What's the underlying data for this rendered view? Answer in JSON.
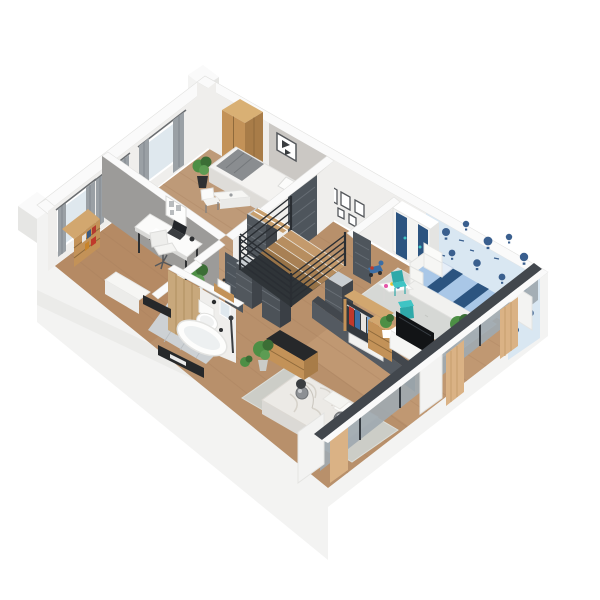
{
  "scene": {
    "type": "3d-floor-plan-cutaway-render",
    "view": "isometric-from-south-west",
    "background": "#ffffff"
  },
  "palette": {
    "background": "#ffffff",
    "exterior_wall": "#f3f3f2",
    "exterior_wall_shade": "#e6e6e4",
    "wall_top": "#fafafa",
    "wall_white": "#efeeec",
    "wall_gray": "#9c9b99",
    "wall_accent": "#cbc8c4",
    "dark_wall": "#42474d",
    "dark_door": "#4e555c",
    "chest_front": "#51575d",
    "chest_side": "#3f444a",
    "chest_top": "#c9ced2",
    "wood_floor": "#b8906b",
    "floor_bedroom": "#c2a284",
    "floor_office": "#b2825e",
    "floor_kids": "#c89f79",
    "wood_furniture": "#c39258",
    "wood_furniture_dark": "#a87c48",
    "wood_light": "#dab285",
    "wood_panel": "#c8a87c",
    "tile": "#cdd1d4",
    "rug_master": "#cccdc7",
    "rug_kids": "#d6d8d5",
    "wallpaper": "#d9e7f2",
    "balloon_navy": "#3a5f8e",
    "kids_navy": "#2c5480",
    "kids_bedding": "#a9c7e7",
    "teal": "#3fc4c4",
    "teal_dark": "#2fa9a9",
    "plant_green": "#4d8f45",
    "curtain": "#9aa0a5",
    "window_glass": "#dfe8ee",
    "white_furniture": "#f6f6f4",
    "bed_linen": "#eceae6",
    "blanket_gray": "#8a8d90",
    "tv_black": "#121416",
    "black_accent": "#26282a",
    "glass_facade": "#9fa9b0"
  },
  "rooms": [
    {
      "name": "single bedroom",
      "position": "north corner",
      "furniture": [
        "wooden wardrobe",
        "single bed with gray blanket",
        "wall picture",
        "vanity desk",
        "white chair",
        "potted plant",
        "window with gray curtains"
      ]
    },
    {
      "name": "home office",
      "position": "west",
      "furniture": [
        "white desk",
        "office chair",
        "laptop",
        "noticeboard",
        "bookshelf with books",
        "white bench",
        "two windows with gray curtains"
      ]
    },
    {
      "name": "hallway with staircase",
      "position": "center",
      "furniture": [
        "staircase with dark metal railing",
        "four dark chests of drawers",
        "five gallery picture frames",
        "dark doors"
      ]
    },
    {
      "name": "kids bedroom",
      "position": "east",
      "furniture": [
        "white-navy wardrobe",
        "kids bed with navy striped bedding",
        "white armchair",
        "play table with teal chairs",
        "ride-on toy",
        "hot-air-balloon wallpaper",
        "gray rug",
        "plants"
      ]
    },
    {
      "name": "master bedroom",
      "position": "south",
      "furniture": [
        "double bed with crumpled duvet",
        "gray rug",
        "tv on sideboard",
        "open wardrobe with clothes",
        "console table with black top",
        "pendant sphere lamps",
        "plants"
      ]
    },
    {
      "name": "bathroom",
      "position": "south-west",
      "furniture": [
        "freestanding bathtub",
        "wall-hung toilet",
        "washbasin on wood counter",
        "wood accent wall",
        "shower column",
        "gray tile floor"
      ]
    }
  ]
}
